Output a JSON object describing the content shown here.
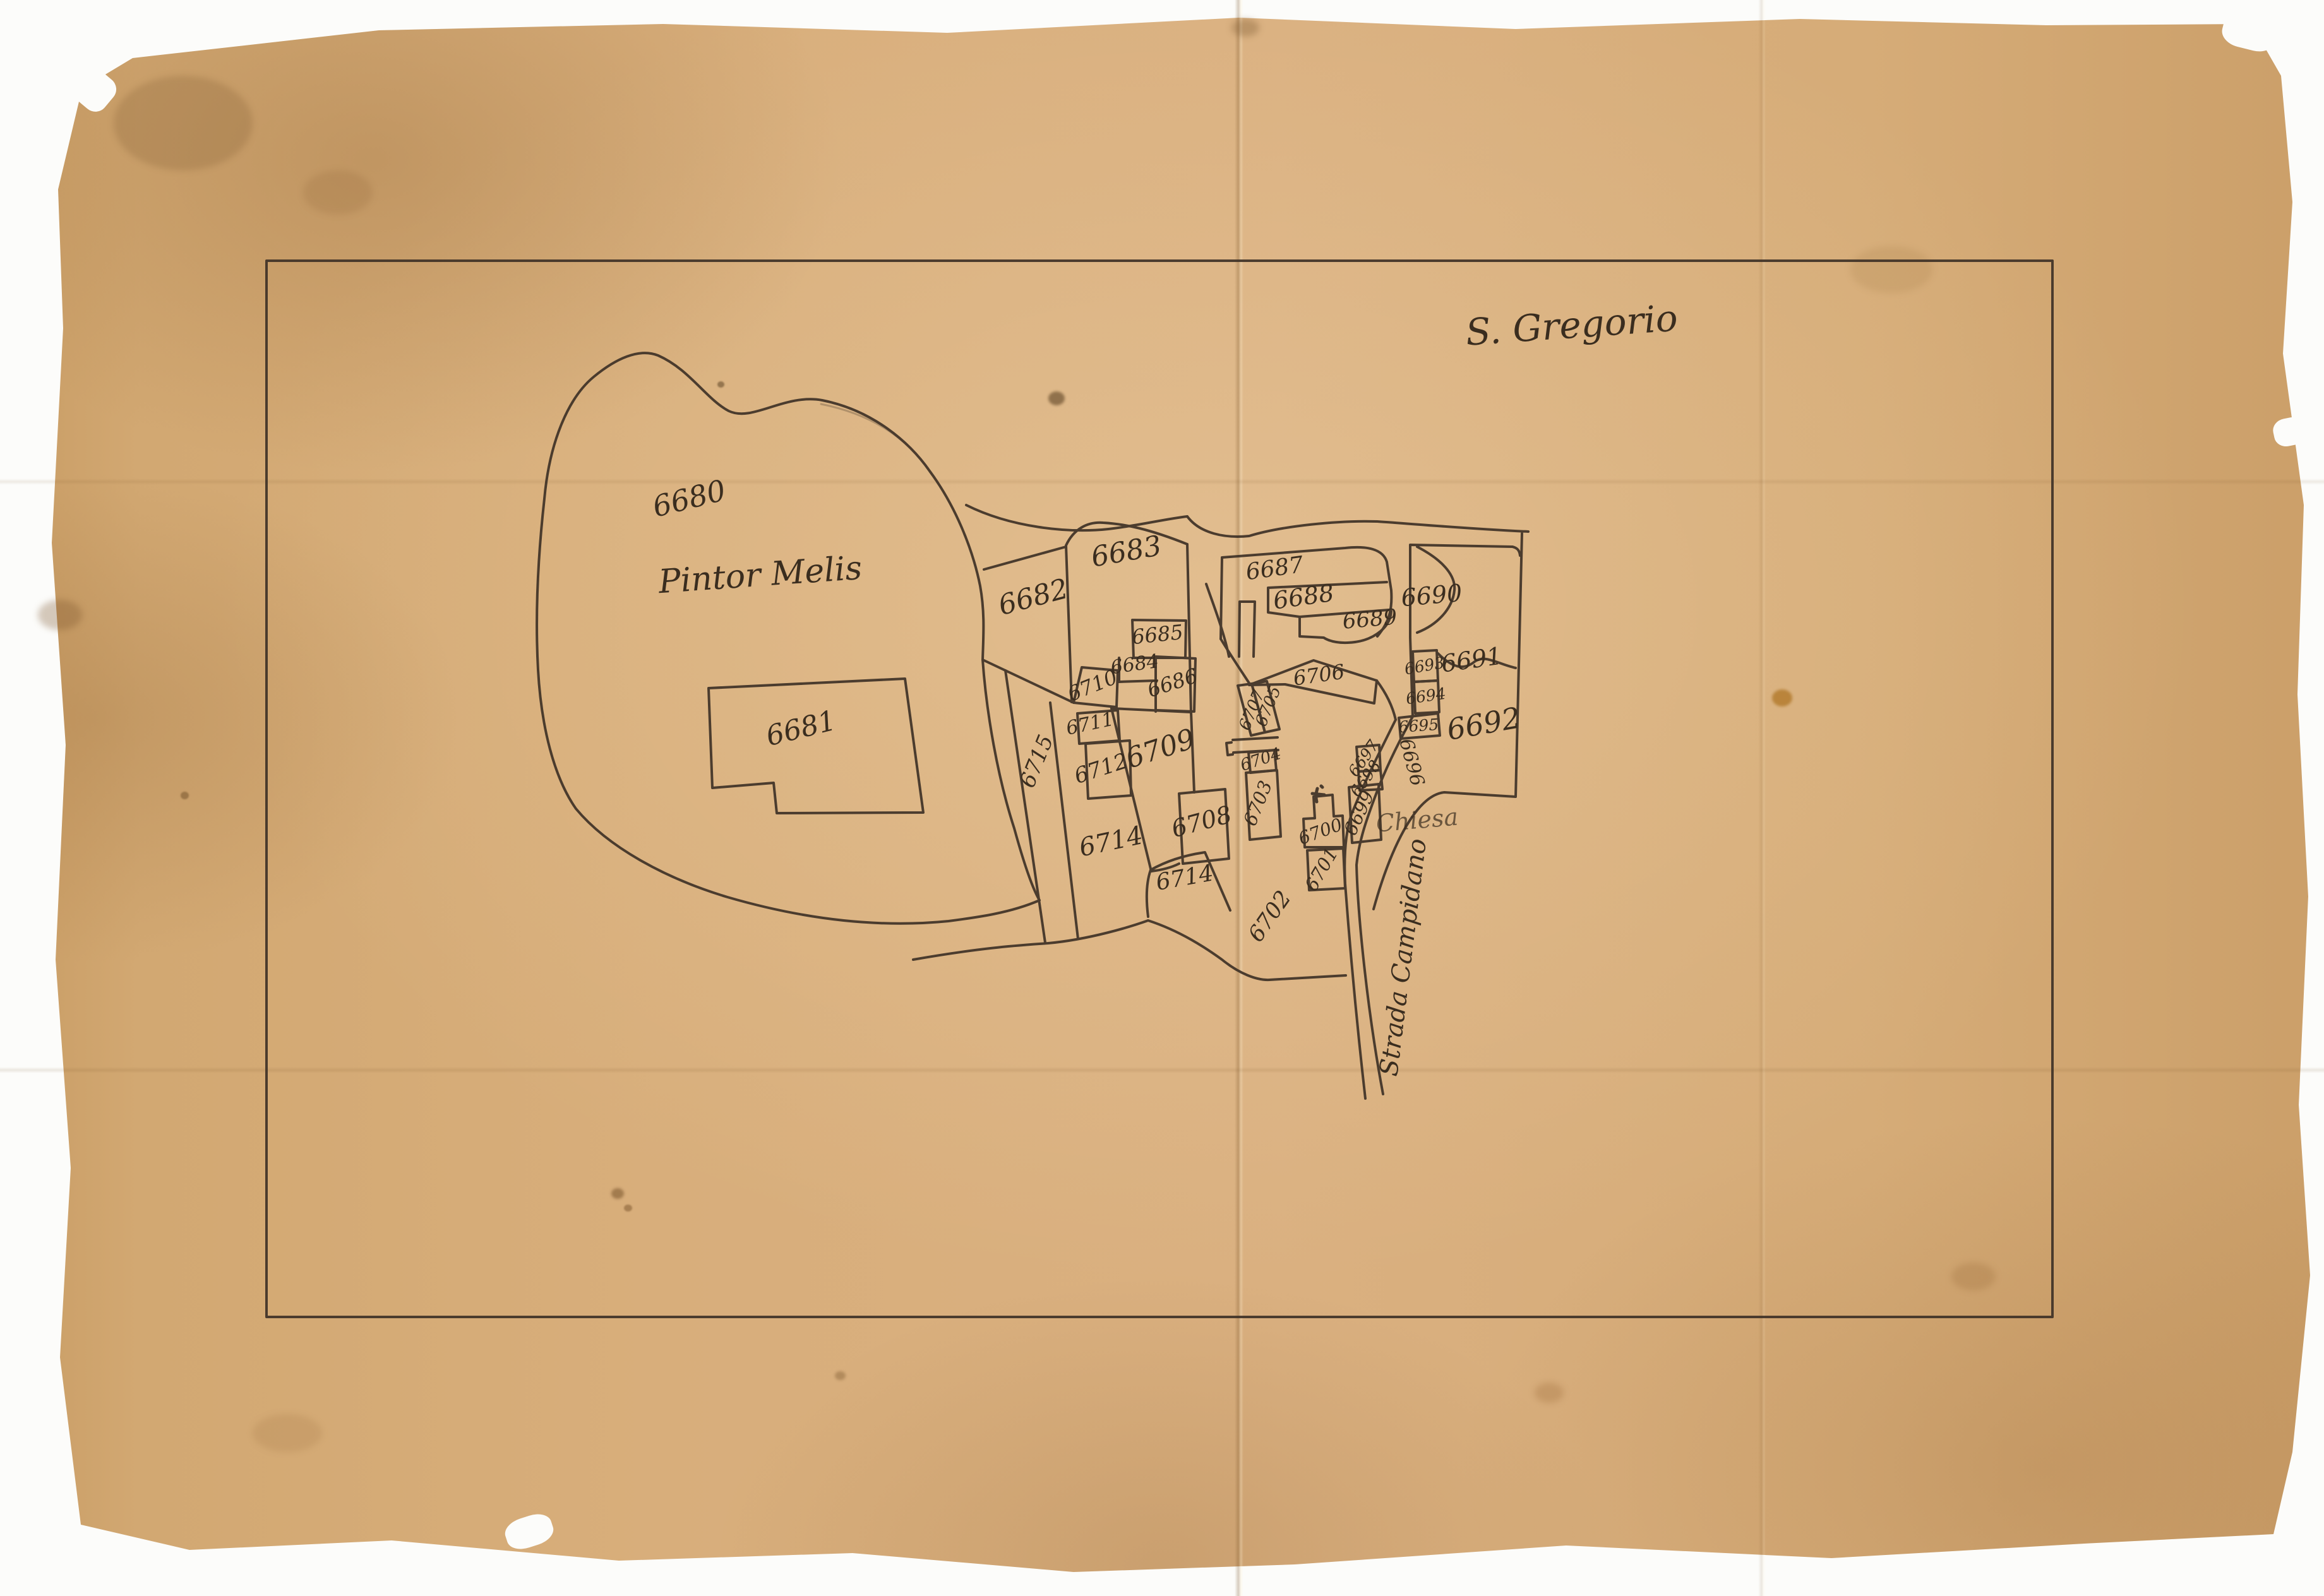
{
  "map": {
    "region_label": "S. Gregorio",
    "owner_label": "Pintor Melis",
    "church_label": "Chiesa",
    "road_label": "Strada Campidano",
    "parcels": [
      "6680",
      "6681",
      "6682",
      "6683",
      "6684",
      "6685",
      "6686",
      "6687",
      "6688",
      "6689",
      "6690",
      "6691",
      "6692",
      "6693",
      "6694",
      "6695",
      "6696",
      "6697",
      "6698",
      "6699",
      "6700",
      "6701",
      "6702",
      "6703",
      "6704",
      "6705",
      "6706",
      "6707",
      "6708",
      "6709",
      "6710",
      "6711",
      "6712",
      "6714",
      "6714",
      "6715"
    ],
    "colors": {
      "paper": "#d6ac78",
      "ink": "#3f3227",
      "backing": "#fcfcfa"
    }
  }
}
